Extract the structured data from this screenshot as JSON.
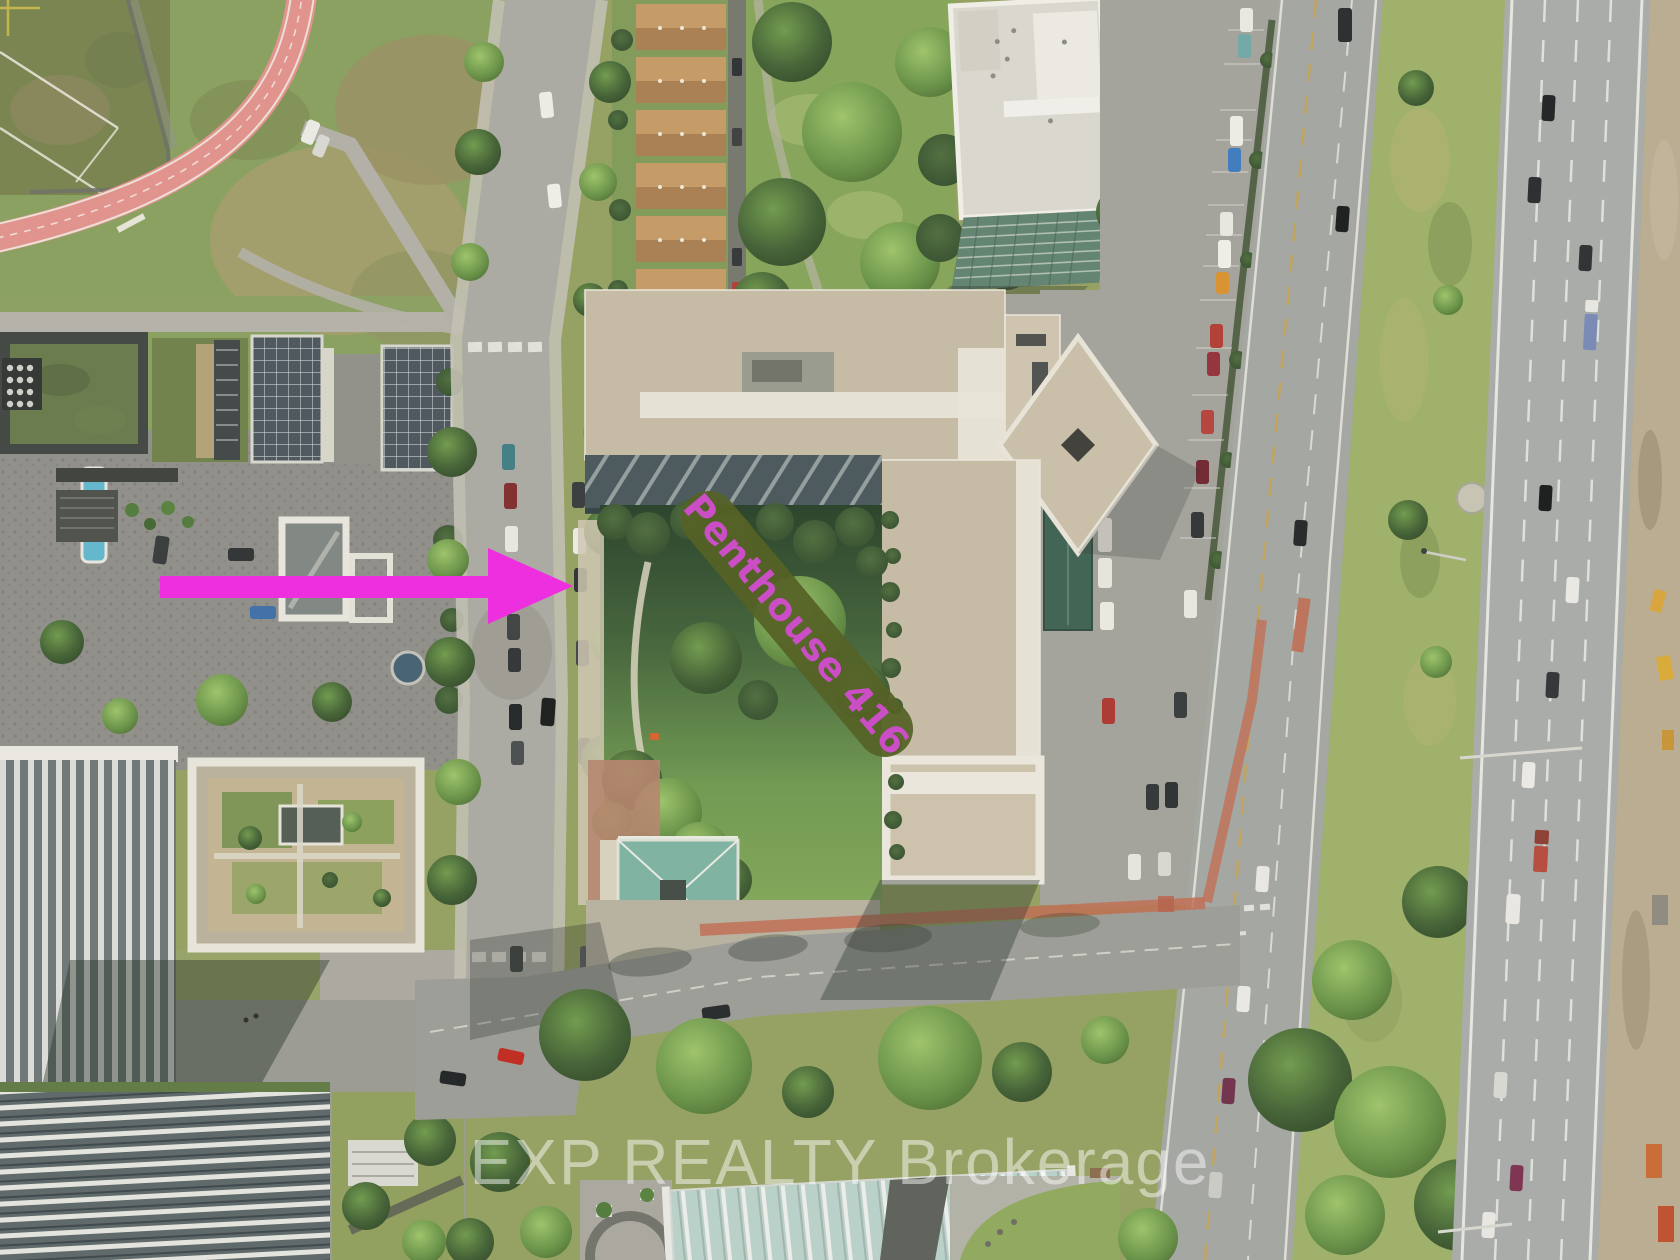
{
  "image": {
    "type": "aerial-drone-photo",
    "description": "Aerial view of a condo complex with interior courtyard garden, flanked by city streets, a landscaped median and a multi-lane highway",
    "width_px": 1680,
    "height_px": 1260
  },
  "annotations": {
    "unit_label": {
      "text": "Penthouse 416",
      "text_color": "#cb4ec6",
      "band_color": "#556226",
      "rotation_deg": 50
    },
    "arrow": {
      "name": "arrow-right-icon",
      "direction": "right",
      "color": "#ee2fe0"
    },
    "watermark": {
      "text": "EXP REALTY Brokerage",
      "color": "#ffffff",
      "opacity": 0.48
    }
  },
  "palette": {
    "building_roof_beige": "#c6bca7",
    "roof_walkway_white": "#e9e6dc",
    "courtyard_lawn": "#7fa657",
    "courtyard_shadow": "#28452a",
    "pavilion_teal": "#7cb3a3",
    "running_track_pink": "#e2918d",
    "terracotta_path": "#bf6b52",
    "road_grey": "#a3a6a3",
    "median_green": "#9db069",
    "dirt_strip": "#baac92"
  },
  "scene": {
    "regions": [
      "sports-field",
      "running-track",
      "west-condo-towers",
      "plaza",
      "c-shaped-condo-building",
      "courtyard-garden",
      "teal-roof-pavilion",
      "local-street",
      "street-parking",
      "arterial-road",
      "grass-median",
      "highway",
      "construction-strip",
      "intersection",
      "glass-roof-building",
      "townhouse-row"
    ]
  }
}
